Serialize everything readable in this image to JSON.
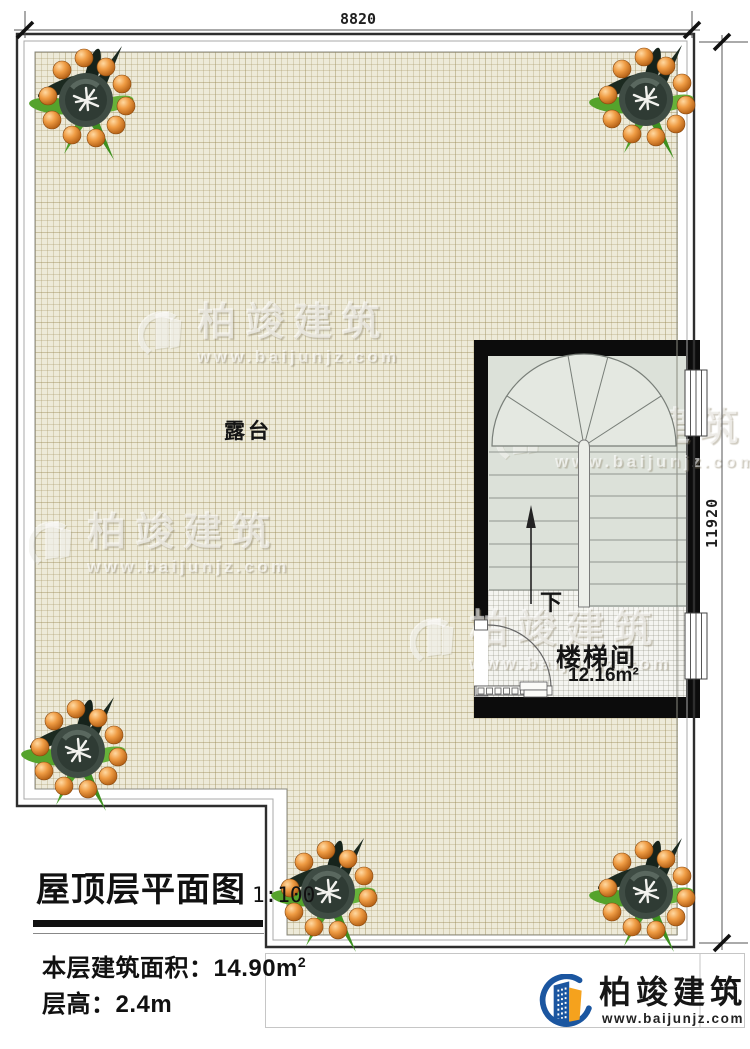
{
  "plan": {
    "terrace_label": "露台",
    "stair_room": {
      "name": "楼梯间",
      "area": "12.16m²",
      "direction_label": "下"
    },
    "dimensions": {
      "top": "8820",
      "right": "11920"
    }
  },
  "title_block": {
    "title": "屋顶层平面图",
    "scale": "1:100",
    "area_text": "本层建筑面积：14.90m",
    "area_sup": "2",
    "floor_height_text": "层高：2.4m"
  },
  "branding": {
    "company": "柏竣建筑",
    "website": "www.baijunjz.com"
  },
  "watermark": {
    "text": "柏竣建筑",
    "site": "www.baijunjz.com"
  },
  "icons": {
    "plant": "potted-plant-top-view",
    "company_logo": "building-swoosh-logo",
    "watermark_logo": "building-swoosh-logo"
  },
  "colors": {
    "terrace_bg": "#edead9",
    "wall": "#0c0c0c",
    "tread": "#dce1d9",
    "floor_tile": "#f4f4f0",
    "brand_blue": "#1b56a0",
    "brand_orange": "#f5a21d",
    "dim_text": "#1f1f1f"
  }
}
